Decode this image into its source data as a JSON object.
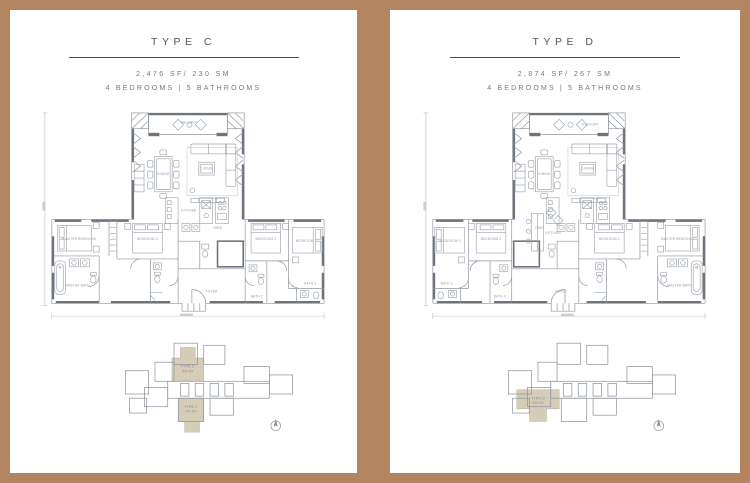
{
  "page": {
    "frame_color": "#b28460",
    "panel_bg": "#ffffff",
    "highlight_color": "#d6cdb8"
  },
  "panels": [
    {
      "title": "TYPE C",
      "area": "2,476 SF/ 230 SM",
      "config": "4 BEDROOMS | 5 BATHROOMS",
      "rooms": {
        "balcony": "BALCONY",
        "dining": "DINING",
        "living": "LIVING",
        "kitchen": "KITCHEN",
        "yard": "YARD",
        "foyer": "FOYER",
        "master_bedroom": "MASTER BEDROOM",
        "bedroom2": "BEDROOM 2",
        "bedroom3": "BEDROOM 3",
        "bedroom4": "BEDROOM 4",
        "master_bath": "MASTER BATH",
        "bath2": "BATH 2",
        "bath3": "BATH 3"
      },
      "keyplan": {
        "unit_top_line1": "TYPE C",
        "unit_top_line2": "XX-XX",
        "unit_bottom_line1": "TYPE C",
        "unit_bottom_line2": "XX-XX"
      }
    },
    {
      "title": "TYPE D",
      "area": "2,874 SF/ 267 SM",
      "config": "4 BEDROOMS | 5 BATHROOMS",
      "rooms": {
        "balcony": "BALCONY",
        "dining": "DINING",
        "living": "LIVING",
        "kitchen": "KITCHEN",
        "yard": "YARD",
        "foyer": "FOYER",
        "master_bedroom": "MASTER BEDROOM",
        "bedroom2": "BEDROOM 2",
        "bedroom3": "BEDROOM 3",
        "bedroom4": "BEDROOM 4",
        "master_bath": "MASTER BATH",
        "bath2": "BATH 2",
        "bath3": "BATH 3"
      },
      "keyplan": {
        "unit_line1": "TYPE D",
        "unit_line2": "XX-XX"
      }
    }
  ]
}
